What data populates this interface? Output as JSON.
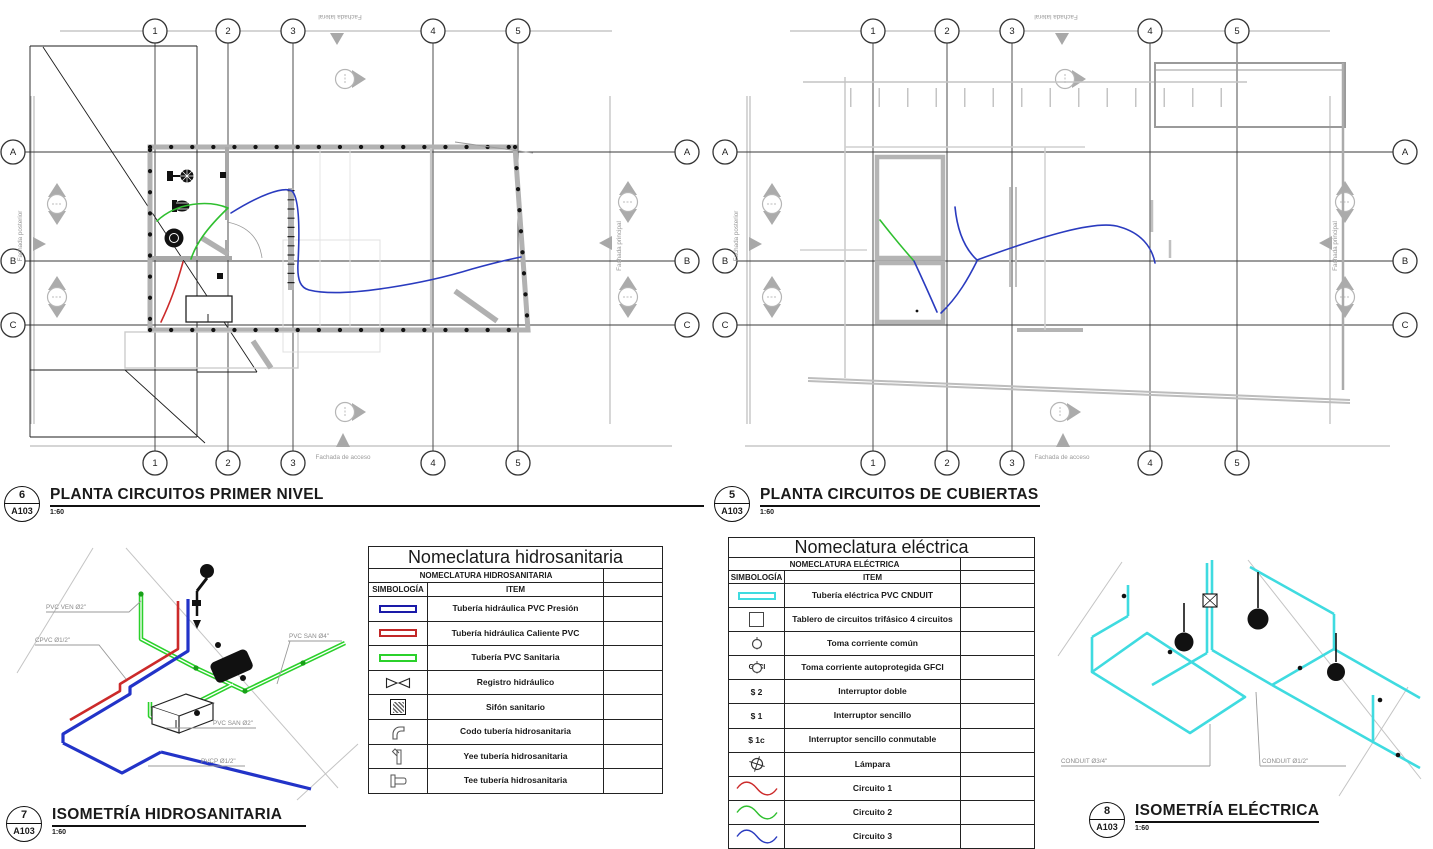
{
  "views": [
    {
      "number": "6",
      "ref": "A103",
      "title": "PLANTA CIRCUITOS PRIMER NIVEL",
      "scale": "1:60"
    },
    {
      "number": "5",
      "ref": "A103",
      "title": "PLANTA CIRCUITOS DE CUBIERTAS",
      "scale": "1:60"
    },
    {
      "number": "7",
      "ref": "A103",
      "title": "ISOMETRÍA HIDROSANITARIA",
      "scale": "1:60"
    },
    {
      "number": "8",
      "ref": "A103",
      "title": "ISOMETRÍA ELÉCTRICA",
      "scale": "1:60"
    }
  ],
  "grid": {
    "columns": [
      "1",
      "2",
      "3",
      "4",
      "5"
    ],
    "rows": [
      "A",
      "B",
      "C"
    ]
  },
  "facades": {
    "lateral": "Fachada lateral",
    "acceso": "Fachada de acceso",
    "posterior": "Fachada posterior",
    "principal": "Fachada principal"
  },
  "iso_hydro": {
    "labels": [
      "PVC VEN Ø2\"",
      "CPVC Ø1/2\"",
      "PVC SAN Ø4\"",
      "PVC SAN Ø2\"",
      "PVCP Ø1/2\""
    ]
  },
  "iso_elec": {
    "labels": [
      "CONDUIT Ø3/4\"",
      "CONDUIT Ø1/2\""
    ]
  },
  "tables": {
    "hidrosanitaria": {
      "title": "Nomeclatura hidrosanitaria",
      "subtitle": "NOMECLATURA HIDROSANITARIA",
      "col_symbol": "SIMBOLOGÍA",
      "col_item": "ITEM",
      "rows": [
        {
          "symbol": "pipe-blue",
          "item": "Tubería hidráulica PVC Presión"
        },
        {
          "symbol": "pipe-red",
          "item": "Tubería hidráulica Caliente PVC"
        },
        {
          "symbol": "pipe-green",
          "item": "Tubería PVC Sanitaria"
        },
        {
          "symbol": "registro-valve",
          "item": "Registro hidráulico"
        },
        {
          "symbol": "sifon-drain",
          "item": "Sifón sanitario"
        },
        {
          "symbol": "codo-elbow",
          "item": "Codo tubería hidrosanitaria"
        },
        {
          "symbol": "yee-fitting",
          "item": "Yee tubería hidrosanitaria"
        },
        {
          "symbol": "tee-fitting",
          "item": "Tee tubería hidrosanitaria"
        }
      ]
    },
    "electrica": {
      "title": "Nomeclatura eléctrica",
      "subtitle": "NOMECLATURA ELÉCTRICA",
      "col_symbol": "SIMBOLOGÍA",
      "col_item": "ITEM",
      "rows": [
        {
          "symbol": "pipe-cyan",
          "item": "Tubería eléctrica PVC CNDUIT"
        },
        {
          "symbol": "panel-square",
          "item": "Tablero de circuitos trifásico 4 circuitos"
        },
        {
          "symbol": "outlet",
          "item": "Toma corriente común"
        },
        {
          "symbol": "outlet-gfci",
          "symbol_label": "GFCI",
          "item": "Toma corriente autoprotegida GFCI"
        },
        {
          "symbol": "switch-double",
          "symbol_label": "$ 2",
          "item": "Interruptor doble"
        },
        {
          "symbol": "switch-single",
          "symbol_label": "$ 1",
          "item": "Interruptor sencillo"
        },
        {
          "symbol": "switch-3way",
          "symbol_label": "$ 1c",
          "item": "Interruptor sencillo conmutable"
        },
        {
          "symbol": "lamp",
          "item": "Lámpara"
        },
        {
          "symbol": "sine-red",
          "item": "Circuito 1"
        },
        {
          "symbol": "sine-green",
          "item": "Circuito 2"
        },
        {
          "symbol": "sine-blue",
          "item": "Circuito 3"
        }
      ]
    }
  },
  "colors": {
    "circuit_1_red": "#cc2a2a",
    "circuit_2_green": "#2fbf2f",
    "circuit_3_blue": "#2a3bbf",
    "conduit_cyan": "#3fdbe0",
    "pipe_pressure_blue": "#1a1aa8",
    "pipe_hot_red": "#c22727",
    "pipe_sanitary_green": "#2bd12b",
    "wall_gray": "#b2b2b2"
  }
}
